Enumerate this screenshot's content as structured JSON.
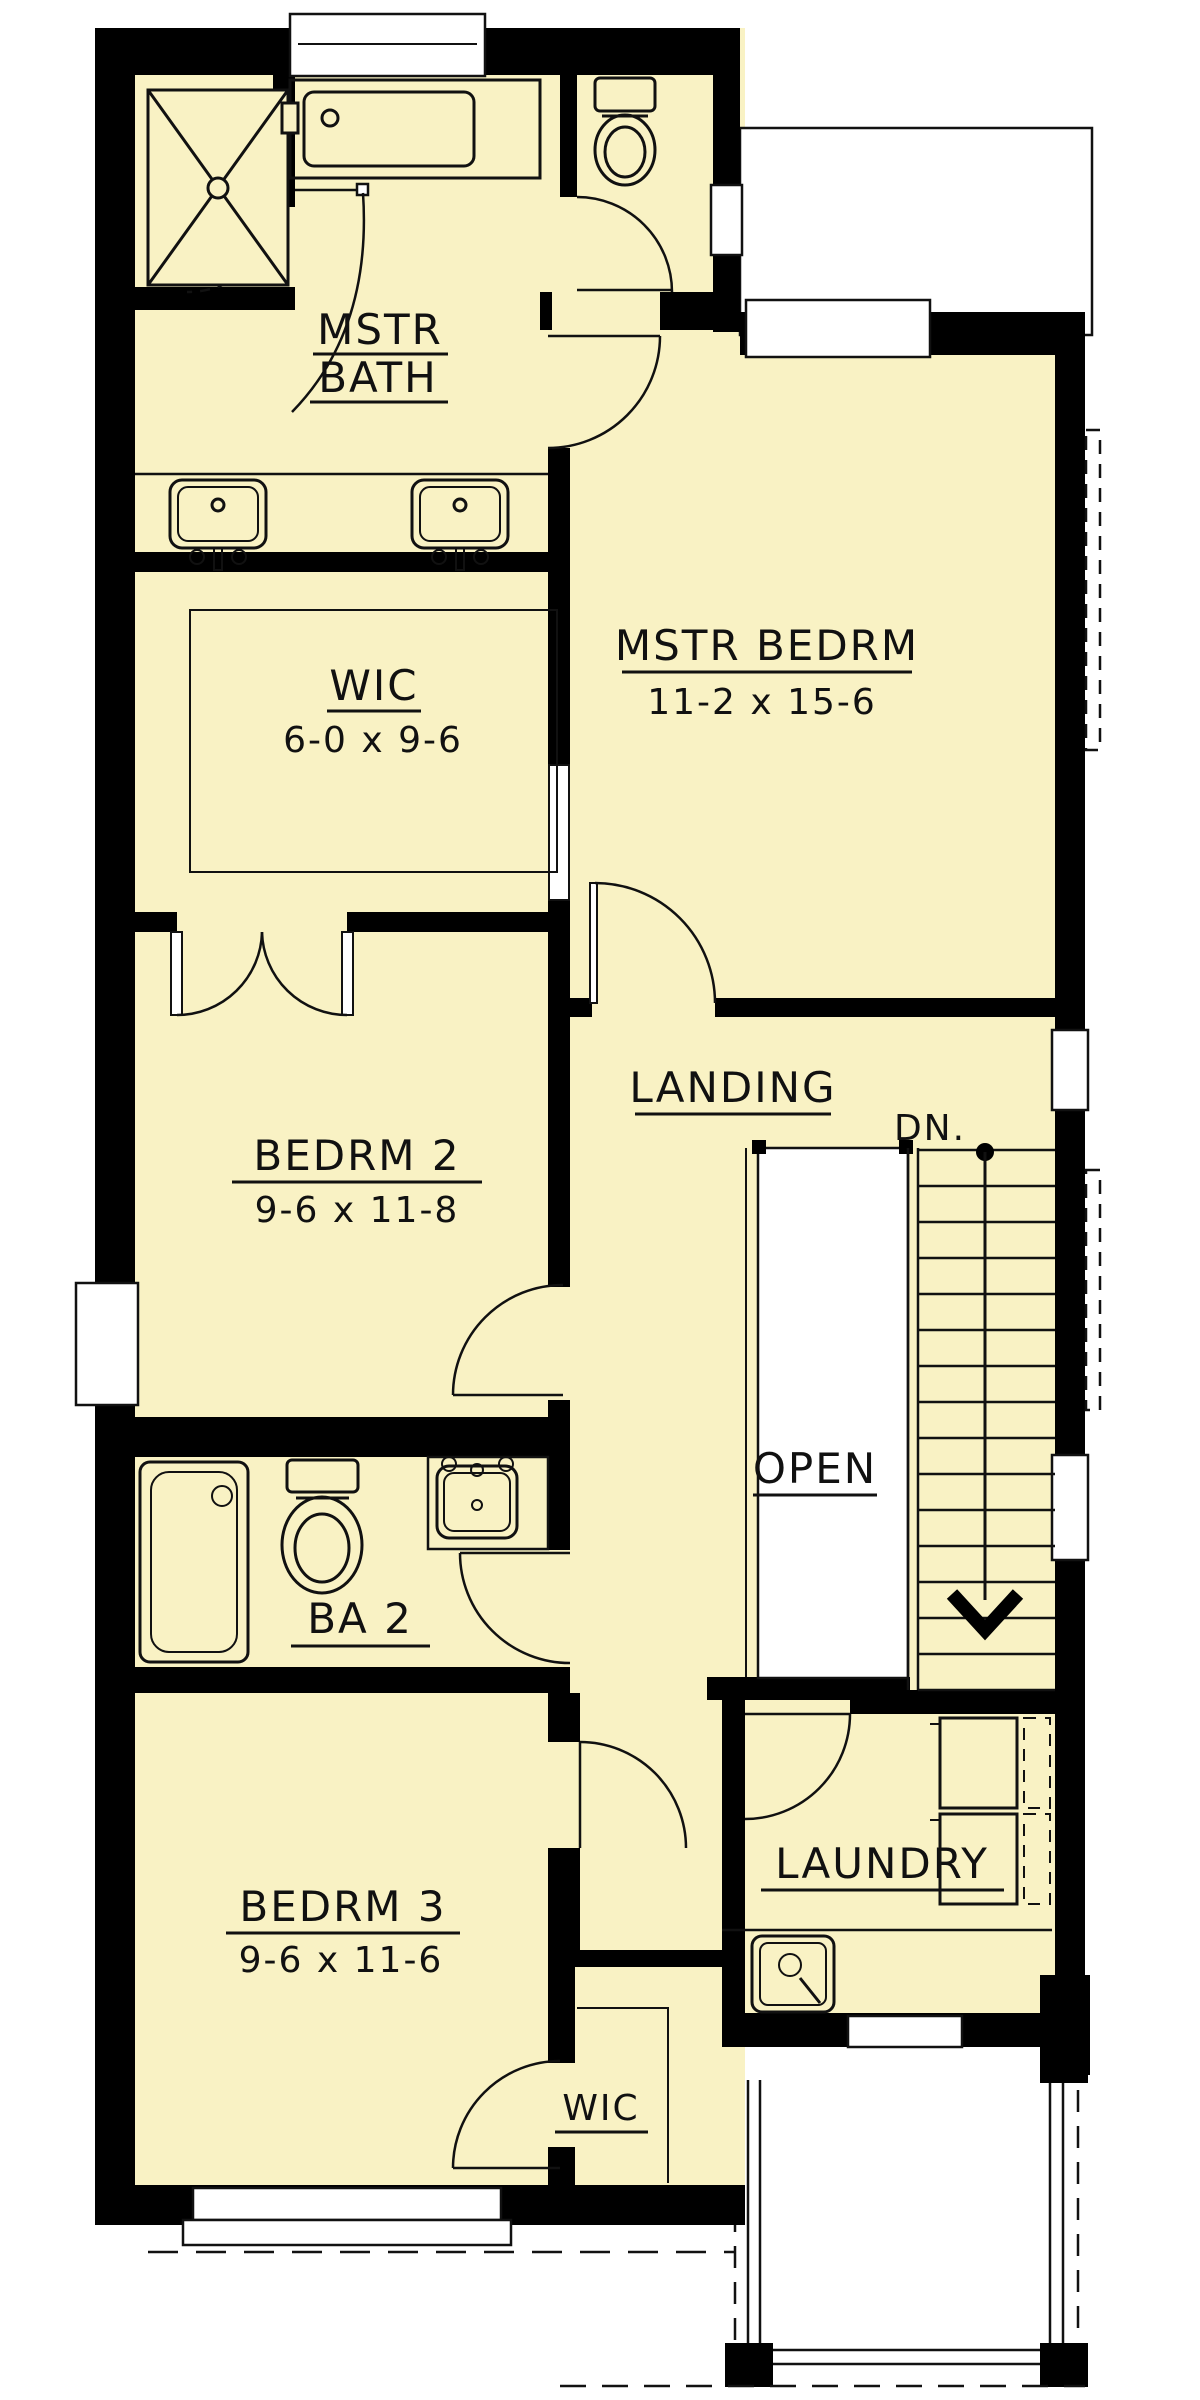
{
  "plan": {
    "type": "floor-plan",
    "colors": {
      "floor": "#F9F2C4",
      "wall": "#000000",
      "line": "#111111",
      "background": "#FFFFFF"
    },
    "rooms": {
      "mstr_bath": {
        "label_line1": "MSTR",
        "label_line2": "BATH"
      },
      "wic_upper": {
        "label": "WIC",
        "dims": "6-0 x 9-6"
      },
      "mstr_bedrm": {
        "label": "MSTR BEDRM",
        "dims": "11-2 x 15-6"
      },
      "landing": {
        "label": "LANDING"
      },
      "stairs": {
        "dn_label": "DN.",
        "open_label": "OPEN"
      },
      "bedrm2": {
        "label": "BEDRM 2",
        "dims": "9-6 x 11-8"
      },
      "ba2": {
        "label": "BA 2"
      },
      "bedrm3": {
        "label": "BEDRM 3",
        "dims": "9-6 x 11-6"
      },
      "laundry": {
        "label": "LAUNDRY"
      },
      "wic_lower": {
        "label": "WIC"
      }
    },
    "fixtures": [
      "shower",
      "bathtub-master",
      "toilet-wc",
      "vanity-sink-left",
      "vanity-sink-right",
      "bathtub-ba2",
      "toilet-ba2",
      "sink-ba2",
      "washer",
      "dryer",
      "laundry-sink"
    ]
  }
}
